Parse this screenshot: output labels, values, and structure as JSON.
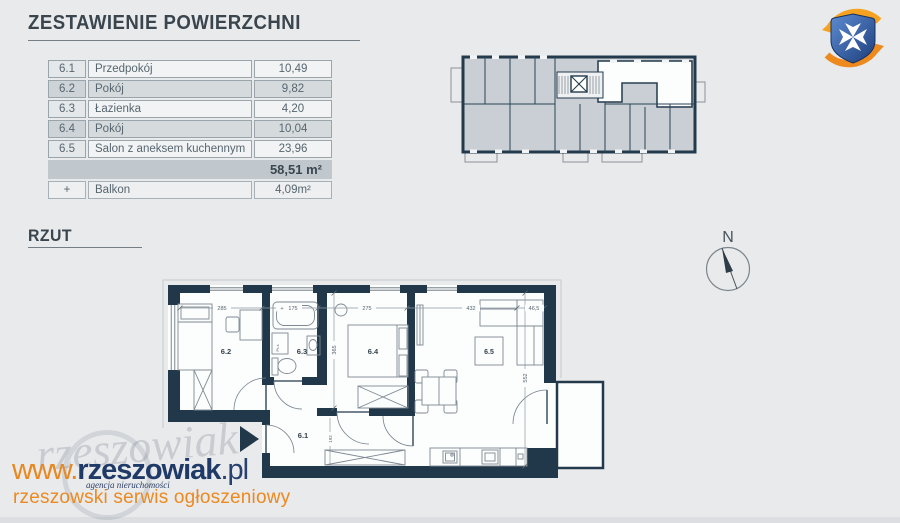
{
  "header": {
    "title": "ZESTAWIENIE POWIERZCHNI"
  },
  "area_table": {
    "rows": [
      {
        "no": "6.1",
        "name": "Przedpokój",
        "area": "10,49"
      },
      {
        "no": "6.2",
        "name": "Pokój",
        "area": "9,82"
      },
      {
        "no": "6.3",
        "name": "Łazienka",
        "area": "4,20"
      },
      {
        "no": "6.4",
        "name": "Pokój",
        "area": "10,04"
      },
      {
        "no": "6.5",
        "name": "Salon z aneksem kuchennym",
        "area": "23,96"
      }
    ],
    "total": "58,51 m²",
    "balcony_row": {
      "no": "+",
      "name": "Balkon",
      "area": "4,09m²"
    }
  },
  "plan": {
    "heading": "RZUT",
    "north_label": "N",
    "room_labels": {
      "r1": "6.1",
      "r2": "6.2",
      "r3": "6.3",
      "r4": "6.4",
      "r5": "6.5"
    },
    "dimensions": {
      "room62_width": "285",
      "tub_plus": "+",
      "tub_length": "175",
      "room64_width": "275",
      "room65_width": "432",
      "sofa_depth": "46,5",
      "room64_height": "365",
      "room65_height": "552",
      "hall_height": "192",
      "washer": "Pr-ś"
    }
  },
  "watermark": {
    "www": "www.",
    "name": "rzeszowiak",
    "tld": ".pl",
    "agency": "agencja nieruchomości",
    "tagline": "rzeszowski serwis ogłoszeniowy",
    "ghost": "rzeszowiak"
  },
  "colors": {
    "wall_navy": "#21384a",
    "building_fill": "#c9cfd4",
    "unit_highlight": "#fcfdfd",
    "accent_orange": "#ec8920",
    "accent_navy": "#1f3a66",
    "background": "#e9eaec"
  }
}
